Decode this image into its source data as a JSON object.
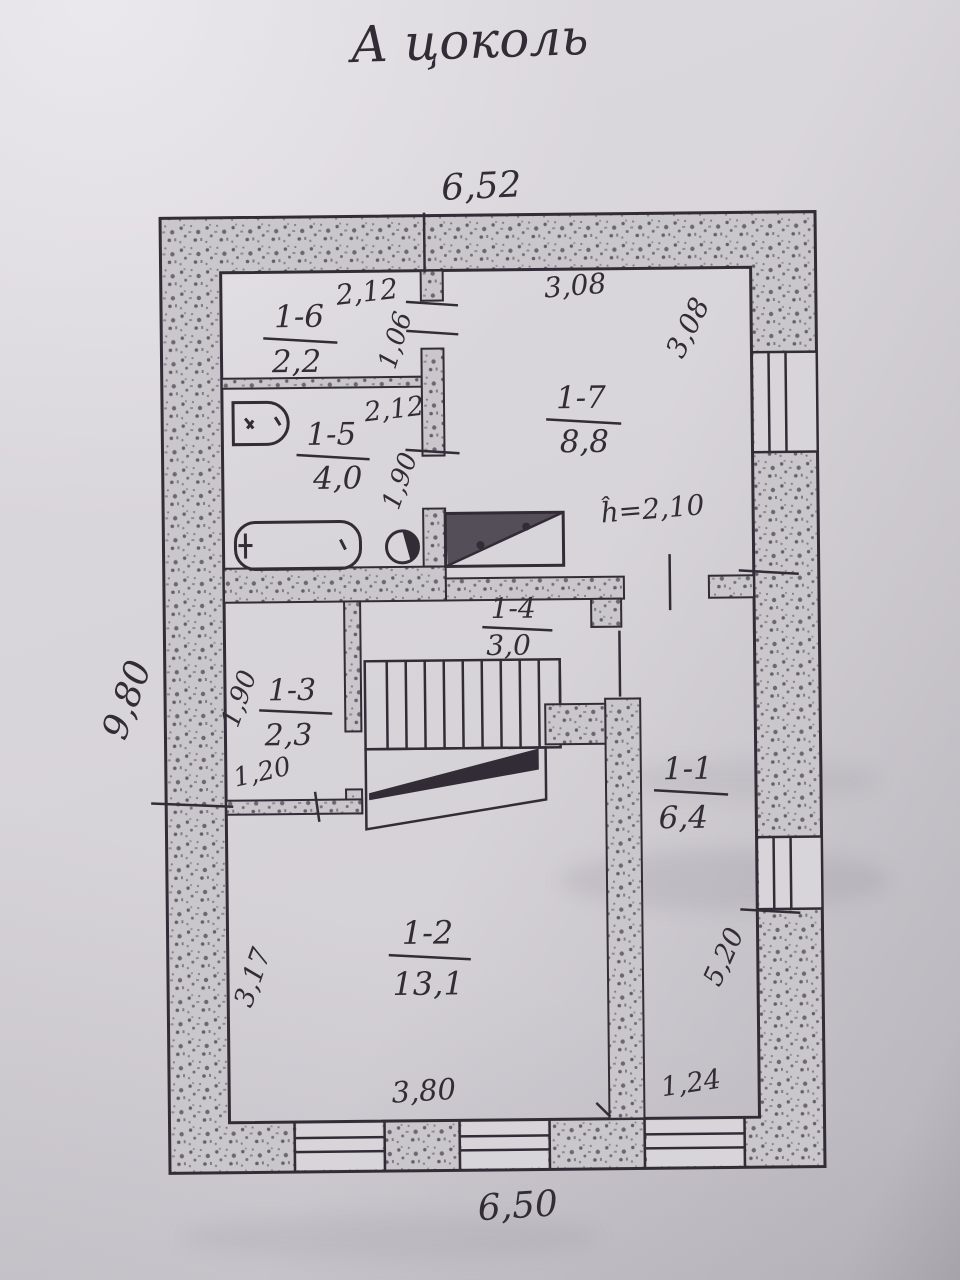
{
  "title": "А цоколь",
  "colors": {
    "ink": "#322c36",
    "paper": "#d8d5da",
    "wall_speckle": "#c9c6cc"
  },
  "outer_dims": {
    "top": "6,52",
    "left": "9,80",
    "bottom": "6,50"
  },
  "height_note": "ĥ=2,10",
  "rooms": [
    {
      "id": "1-1",
      "area": "6,4"
    },
    {
      "id": "1-2",
      "area": "13,1"
    },
    {
      "id": "1-3",
      "area": "2,3"
    },
    {
      "id": "1-4",
      "area": "3,0"
    },
    {
      "id": "1-5",
      "area": "4,0"
    },
    {
      "id": "1-6",
      "area": "2,2"
    },
    {
      "id": "1-7",
      "area": "8,8"
    }
  ],
  "dims": {
    "room16_width": "2,12",
    "room16_height": "1,06",
    "room17_width": "3,08",
    "room17_height": "3,08",
    "room15_width": "2,12",
    "room15_height": "1,90",
    "room13_height": "1,90",
    "room13_width": "1,20",
    "room12_height": "3,17",
    "room12_width": "3,80",
    "room11_width": "1,24",
    "room11_height": "5,20"
  }
}
